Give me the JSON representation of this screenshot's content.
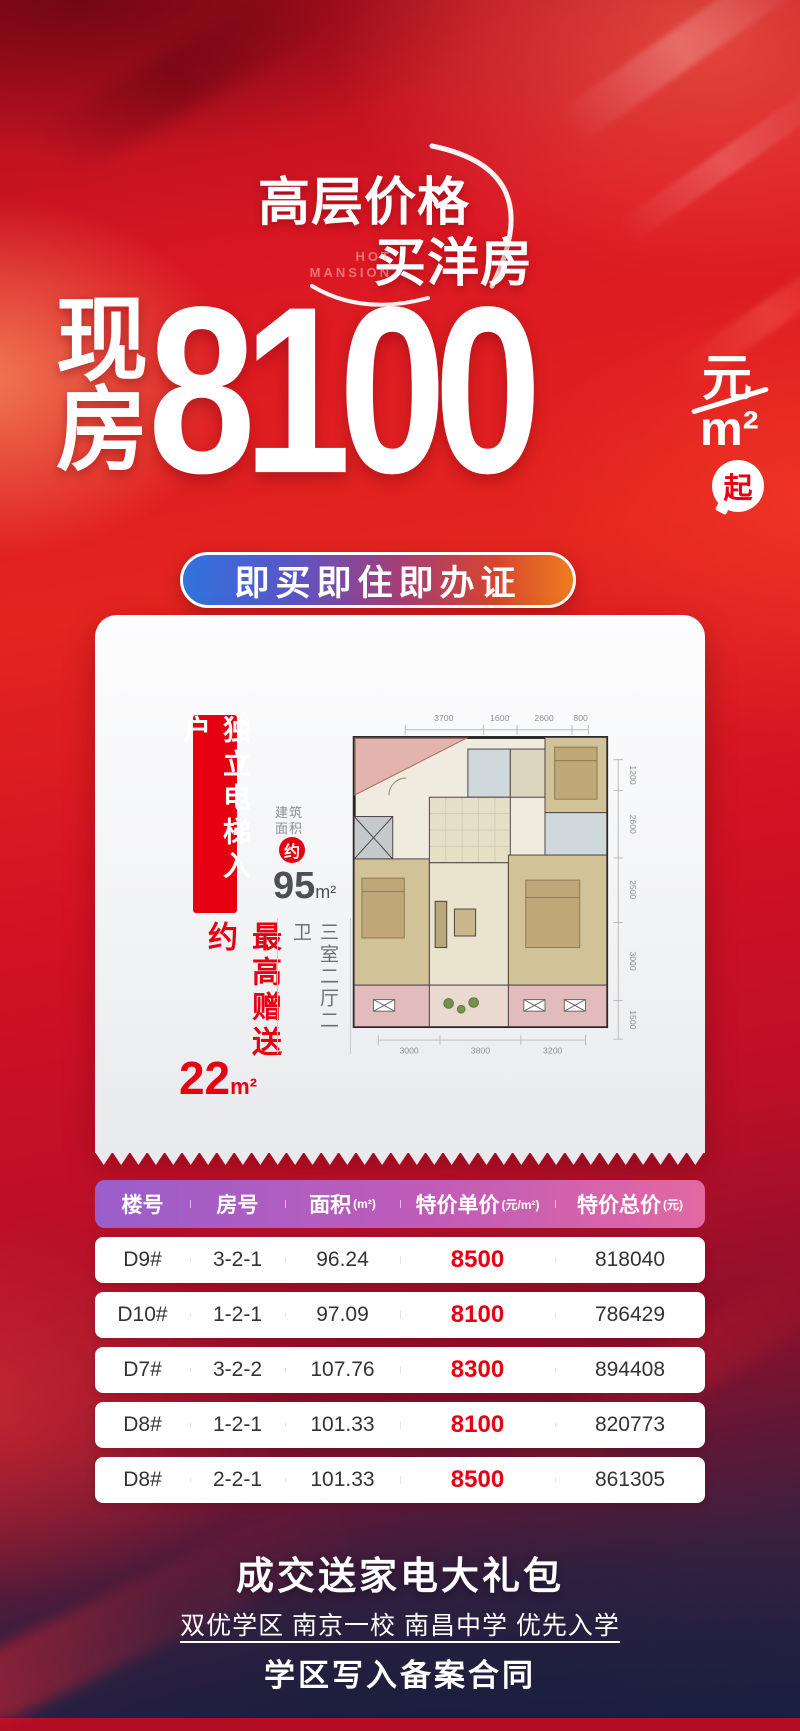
{
  "header": {
    "tagline_line1": "高层价格",
    "tagline_line2": "买洋房",
    "tagline_en_line1": "HOT",
    "tagline_en_line2": "MANSION"
  },
  "price": {
    "prefix_char1": "现",
    "prefix_char2": "房",
    "amount": "8100",
    "unit_currency": "元",
    "unit_area": "m²",
    "suffix": "起"
  },
  "ribbon": {
    "text": "即买即住即办证"
  },
  "card": {
    "vertical_banner": "独立电梯入户",
    "gift_label": "最高赠送约",
    "gift_value": "22",
    "gift_unit": "m²",
    "area_label_line1": "建筑",
    "area_label_line2": "面积",
    "area_approx": "约",
    "area_value": "95",
    "area_unit": "m²",
    "layout_text": "三室二厅二卫",
    "floorplan": {
      "dims_top": [
        "3700",
        "1600",
        "2600",
        "800"
      ],
      "dims_right": [
        "1200",
        "2600",
        "2500",
        "3000",
        "1500"
      ],
      "dims_bottom": [
        "3000",
        "3800",
        "3200"
      ]
    }
  },
  "table": {
    "headers": {
      "building": "楼号",
      "room": "房号",
      "area": "面积",
      "area_unit": "(m²)",
      "unit_price": "特价单价",
      "unit_price_unit": "(元/m²)",
      "total_price": "特价总价",
      "total_price_unit": "(元)"
    },
    "rows": [
      {
        "building": "D9#",
        "room": "3-2-1",
        "area": "96.24",
        "unit_price": "8500",
        "total_price": "818040"
      },
      {
        "building": "D10#",
        "room": "1-2-1",
        "area": "97.09",
        "unit_price": "8100",
        "total_price": "786429"
      },
      {
        "building": "D7#",
        "room": "3-2-2",
        "area": "107.76",
        "unit_price": "8300",
        "total_price": "894408"
      },
      {
        "building": "D8#",
        "room": "1-2-1",
        "area": "101.33",
        "unit_price": "8100",
        "total_price": "820773"
      },
      {
        "building": "D8#",
        "room": "2-2-1",
        "area": "101.33",
        "unit_price": "8500",
        "total_price": "861305"
      }
    ]
  },
  "footer": {
    "line1": "成交送家电大礼包",
    "line2": "双优学区 南京一校 南昌中学 优先入学",
    "line3": "学区写入备案合同"
  },
  "colors": {
    "accent_red": "#e60012",
    "ribbon_blue": "#2f74dd",
    "ribbon_orange": "#ef7d1f",
    "table_header_purple": "#9a5ecb",
    "table_header_pink": "#e268a2",
    "bottom_navy": "#1b2340"
  }
}
